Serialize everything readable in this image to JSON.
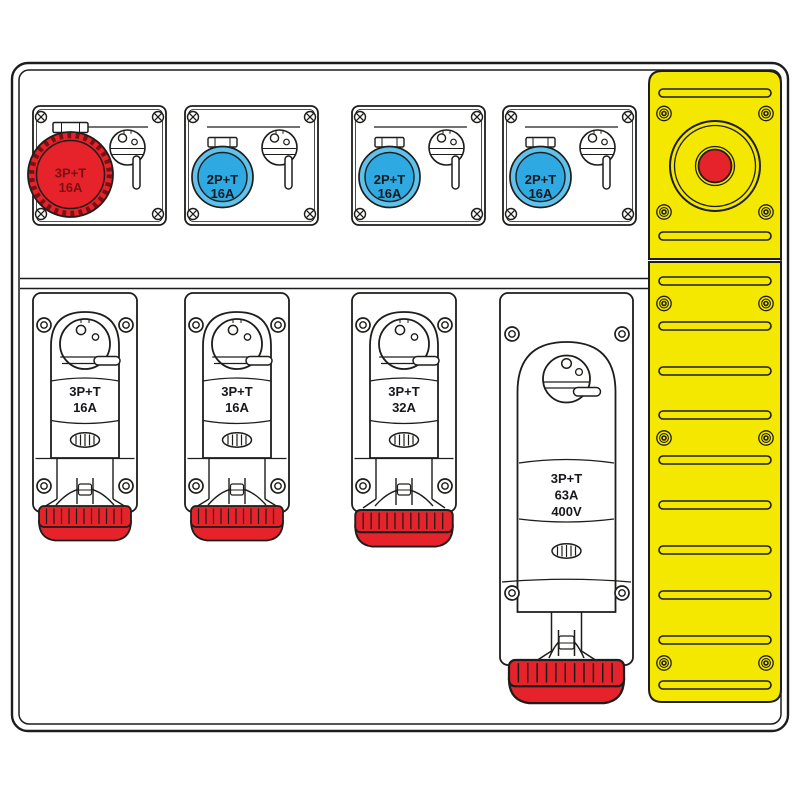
{
  "top_row": [
    {
      "line1": "3P+T",
      "line2": "16A",
      "color": "red"
    },
    {
      "line1": "2P+T",
      "line2": "16A",
      "color": "blue"
    },
    {
      "line1": "2P+T",
      "line2": "16A",
      "color": "blue"
    },
    {
      "line1": "2P+T",
      "line2": "16A",
      "color": "blue"
    }
  ],
  "bottom_row": [
    {
      "line1": "3P+T",
      "line2": "16A"
    },
    {
      "line1": "3P+T",
      "line2": "16A"
    },
    {
      "line1": "3P+T",
      "line2": "32A"
    },
    {
      "line1": "3P+T",
      "line2": "63A",
      "line3": "400V"
    }
  ],
  "colors": {
    "outline": "#1d1d1b",
    "socket_red": "#e6232b",
    "socket_red_dark": "#7a1013",
    "socket_blue": "#2fa9e1",
    "socket_blue_light": "#5fc2ec",
    "panel_yellow": "#f5e800",
    "estop_red": "#e6232b"
  },
  "icons": {
    "emergency_stop": "emergency-stop-button",
    "rotary_switch": "rotary-switch-icon",
    "phillips_screw": "phillips-screw-icon",
    "ring_screw": "ring-screw-icon",
    "panel_screw": "panel-screw-icon",
    "vent_slot": "ventilation-slot",
    "vent_grille": "vent-grille-icon",
    "protective_cap": "socket-cap",
    "hinge_tab": "socket-lid-hinge"
  }
}
